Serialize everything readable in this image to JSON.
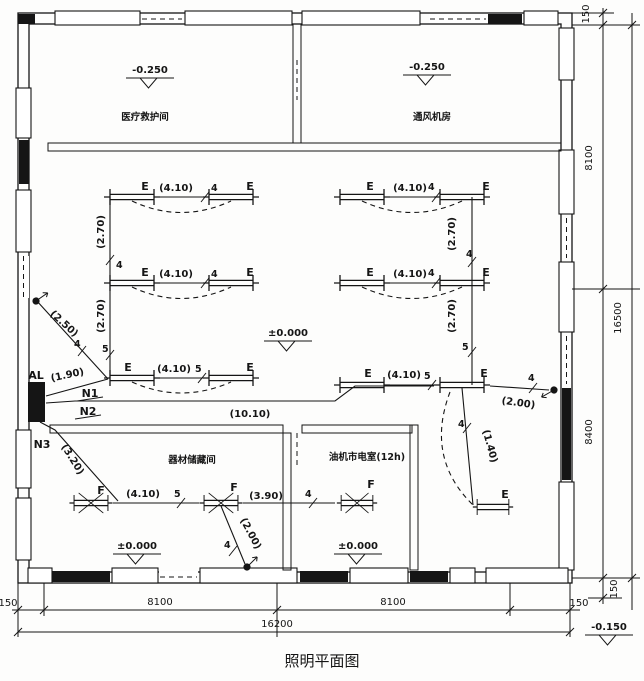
{
  "title": "照明平面图",
  "rooms": {
    "top_left": {
      "name": "医疗救护间",
      "level": "-0.250"
    },
    "top_right": {
      "name": "通风机房",
      "level": "-0.250"
    },
    "hall": {
      "level": "±0.000"
    },
    "storage": {
      "name": "器材储藏间",
      "level": "±0.000"
    },
    "power": {
      "name": "油机市电室(12h)",
      "level": "±0.000"
    },
    "outside_level": "-0.150"
  },
  "panel": {
    "label": "AL"
  },
  "circuits": {
    "n1": "N1",
    "n2": "N2",
    "n3": "N3"
  },
  "lamp_labels": {
    "fluorescent": "E",
    "sealed": "F"
  },
  "wire_lengths": {
    "l140": "(1.40)",
    "l190": "(1.90)",
    "l200": "(2.00)",
    "l250": "(2.50)",
    "l270": "(2.70)",
    "l320": "(3.20)",
    "l390": "(3.90)",
    "l410": "(4.10)",
    "l1010": "(10.10)"
  },
  "conductor_counts": {
    "four": "4",
    "five": "5"
  },
  "dimensions": {
    "top_right_offset": "150",
    "right_seg1": "8100",
    "right_seg2": "8400",
    "right_total": "16500",
    "right_bottom_offset": "150",
    "bottom_left_offset": "150",
    "bottom_seg1": "8100",
    "bottom_seg2": "8100",
    "bottom_right_offset": "150",
    "bottom_total": "16200"
  }
}
